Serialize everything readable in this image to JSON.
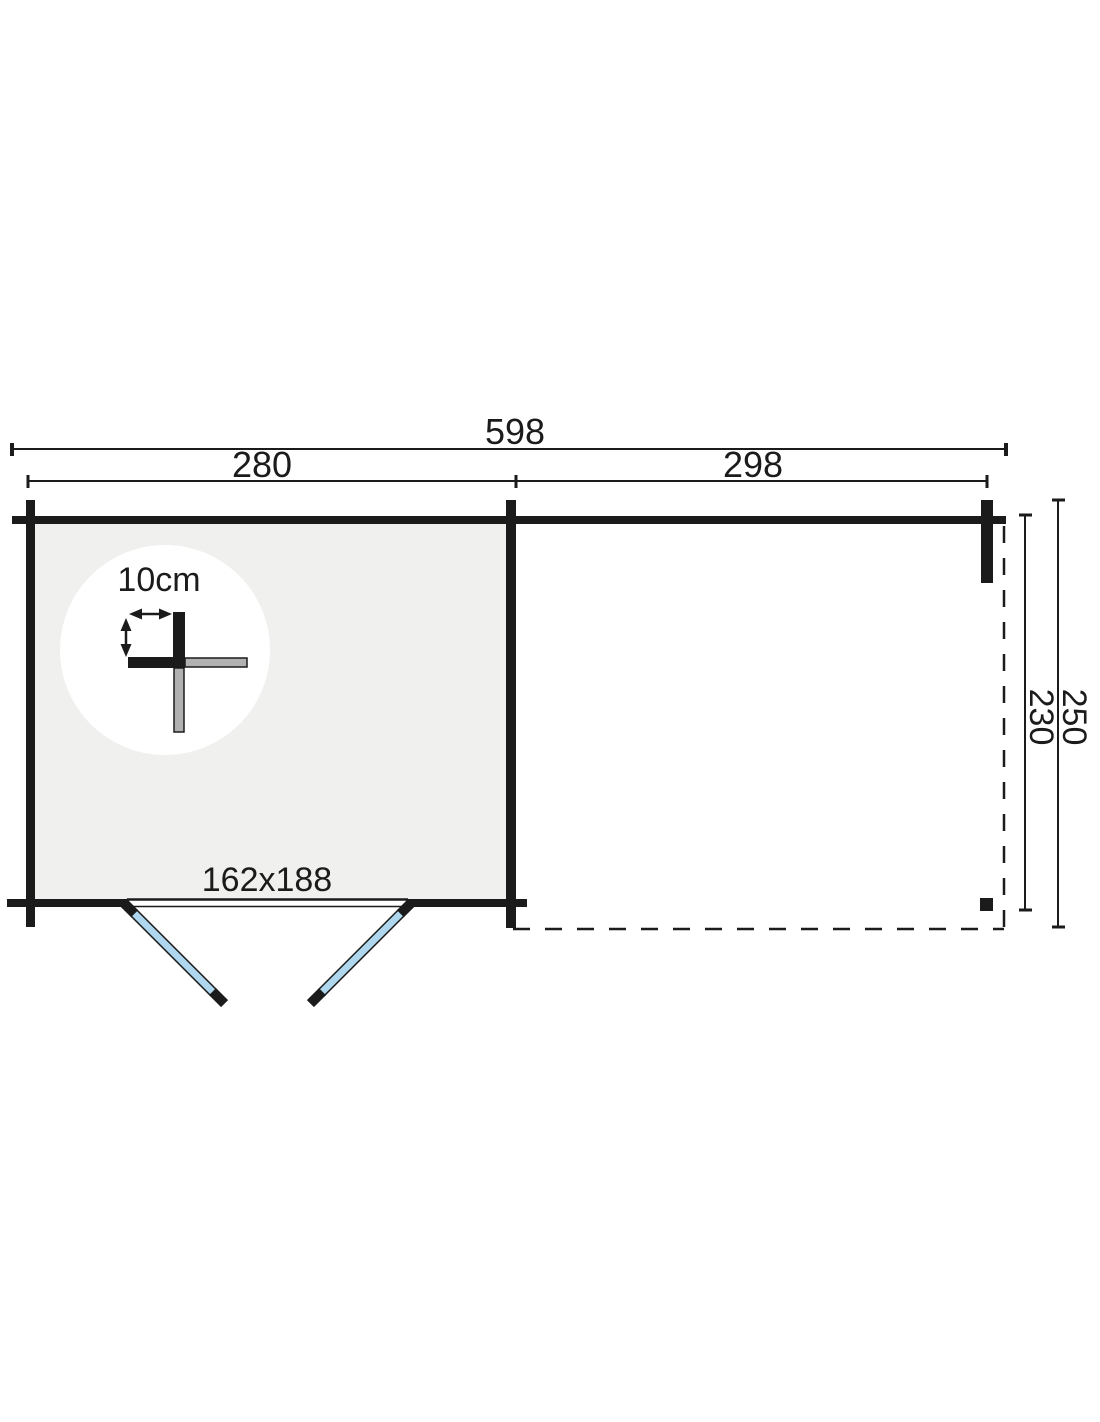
{
  "plan": {
    "dims": {
      "total_width": "598",
      "cabin_width": "280",
      "canopy_width": "298",
      "total_depth": "250",
      "inner_depth": "230"
    },
    "door": {
      "size": "162x188"
    },
    "wall_detail": {
      "thickness": "10cm"
    },
    "colors": {
      "line": "#1b1b1b",
      "cabin_floor": "#f0f0ee",
      "door_leaf": "#aed7ee",
      "log_gray": "#b1b1b1",
      "background": "#ffffff"
    }
  }
}
